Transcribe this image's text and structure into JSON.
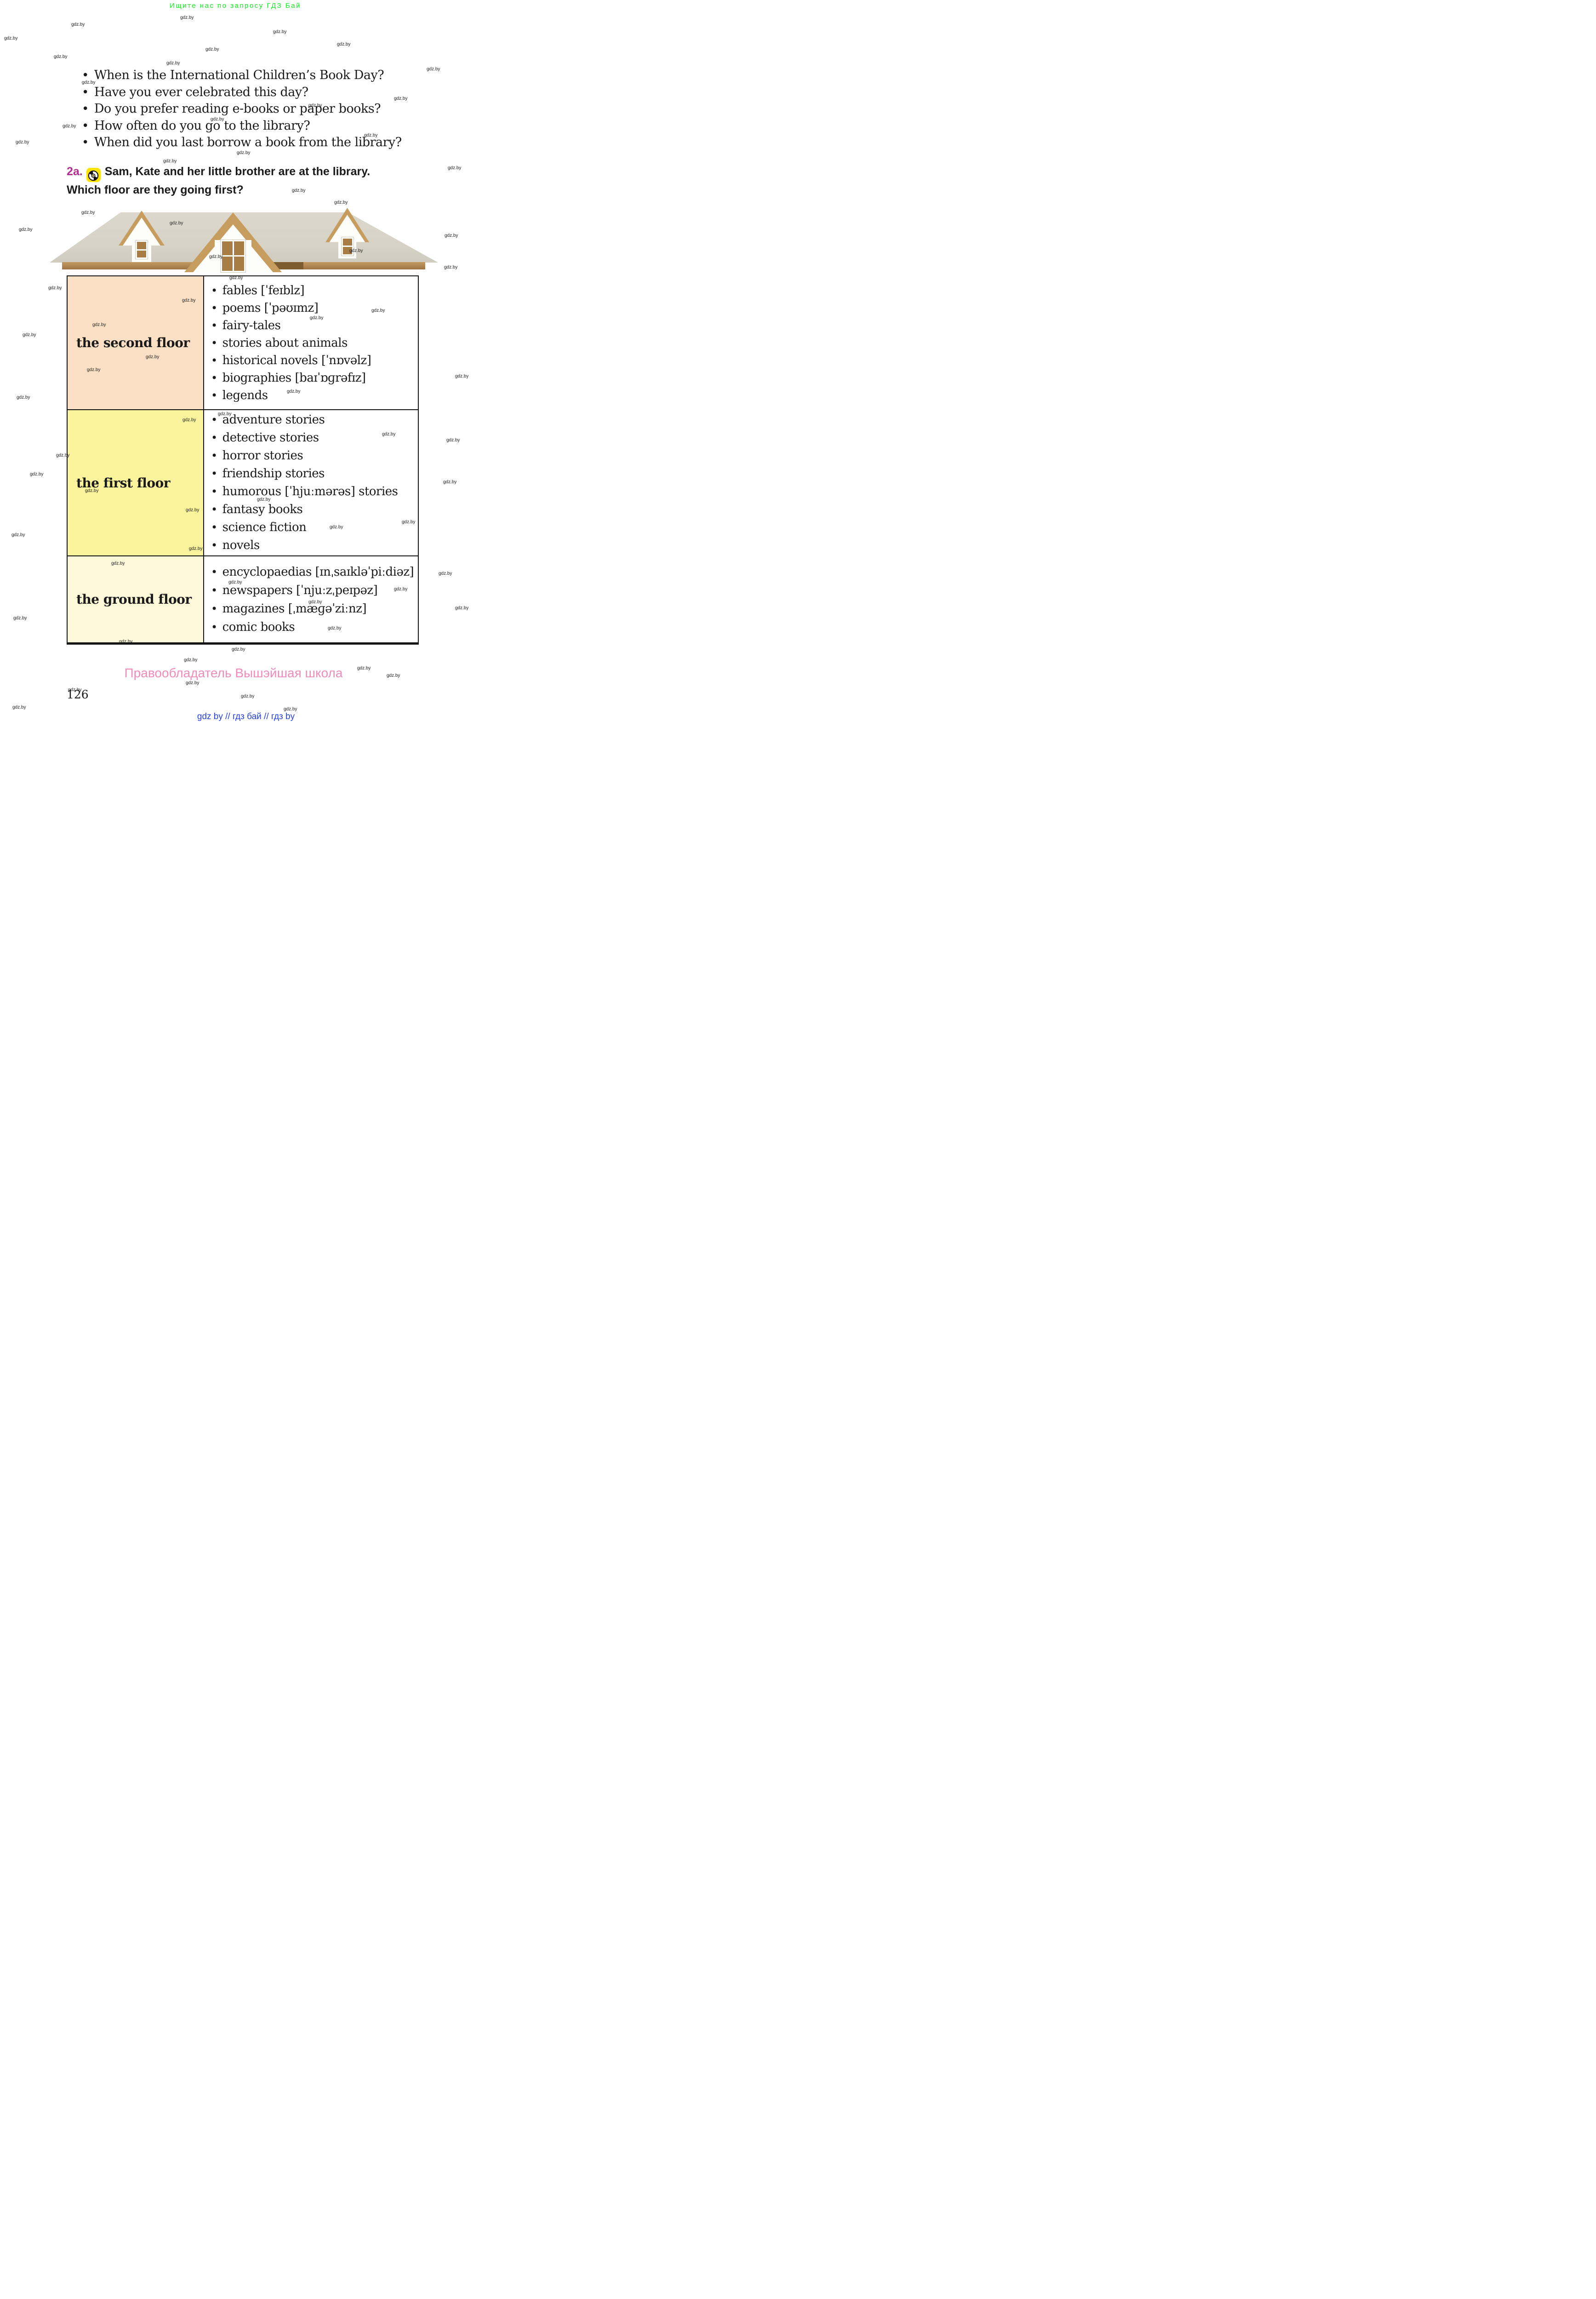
{
  "banner": {
    "text": "Ищите нас по запросу ГДЗ Бай",
    "color": "#0bf01b"
  },
  "watermark": {
    "text": "gdz.by",
    "positions": [
      [
        392,
        33
      ],
      [
        155,
        48
      ],
      [
        9,
        78
      ],
      [
        594,
        64
      ],
      [
        733,
        91
      ],
      [
        447,
        102
      ],
      [
        117,
        118
      ],
      [
        362,
        132
      ],
      [
        928,
        145
      ],
      [
        178,
        174
      ],
      [
        857,
        209
      ],
      [
        671,
        224
      ],
      [
        458,
        254
      ],
      [
        136,
        269
      ],
      [
        792,
        289
      ],
      [
        34,
        304
      ],
      [
        515,
        327
      ],
      [
        355,
        345
      ],
      [
        974,
        360
      ],
      [
        635,
        409
      ],
      [
        727,
        435
      ],
      [
        177,
        457
      ],
      [
        369,
        480
      ],
      [
        41,
        494
      ],
      [
        967,
        507
      ],
      [
        455,
        553
      ],
      [
        760,
        540
      ],
      [
        966,
        576
      ],
      [
        499,
        599
      ],
      [
        105,
        621
      ],
      [
        396,
        648
      ],
      [
        808,
        670
      ],
      [
        674,
        686
      ],
      [
        201,
        701
      ],
      [
        49,
        723
      ],
      [
        317,
        771
      ],
      [
        189,
        799
      ],
      [
        990,
        813
      ],
      [
        624,
        846
      ],
      [
        36,
        859
      ],
      [
        474,
        895
      ],
      [
        397,
        908
      ],
      [
        831,
        939
      ],
      [
        971,
        952
      ],
      [
        122,
        985
      ],
      [
        65,
        1026
      ],
      [
        964,
        1043
      ],
      [
        185,
        1062
      ],
      [
        559,
        1081
      ],
      [
        404,
        1104
      ],
      [
        874,
        1130
      ],
      [
        717,
        1141
      ],
      [
        25,
        1158
      ],
      [
        411,
        1188
      ],
      [
        242,
        1220
      ],
      [
        954,
        1242
      ],
      [
        497,
        1261
      ],
      [
        857,
        1276
      ],
      [
        671,
        1304
      ],
      [
        990,
        1317
      ],
      [
        29,
        1339
      ],
      [
        713,
        1361
      ],
      [
        259,
        1390
      ],
      [
        504,
        1407
      ],
      [
        400,
        1430
      ],
      [
        777,
        1448
      ],
      [
        841,
        1464
      ],
      [
        404,
        1480
      ],
      [
        148,
        1495
      ],
      [
        524,
        1509
      ],
      [
        27,
        1533
      ],
      [
        617,
        1537
      ]
    ]
  },
  "questions": {
    "items": [
      "When is the International Children’s Book Day?",
      "Have you ever celebrated this day?",
      "Do you prefer reading e-books or paper books?",
      "How often do you go to the library?",
      "When did you last borrow a book from the library?"
    ]
  },
  "exercise": {
    "number": "2a.",
    "icon": "cd-icon",
    "line1": "Sam, Kate and her little brother are at the library.",
    "line2": "Which floor are they going first?"
  },
  "library": {
    "floors": [
      {
        "label": "the second floor",
        "bg": "#fbe0c6",
        "items": [
          "fables [ˈfeɪblz]",
          "poems [ˈpəʊɪmz]",
          "fairy-tales",
          "stories about animals",
          "historical novels [ˈnɒvəlz]",
          "biographies [baɪˈɒɡrəfɪz]",
          "legends"
        ]
      },
      {
        "label": "the first floor",
        "bg": "#fbf49d",
        "items": [
          "adventure stories",
          "detective stories",
          "horror stories",
          "friendship stories",
          "humorous [ˈhjuːmərəs] stories",
          "fantasy books",
          "science fiction",
          "novels"
        ]
      },
      {
        "label": "the ground floor",
        "bg": "#fdf8da",
        "items": [
          "encyclopaedias [ɪnˌsaɪkləˈpiːdiəz]",
          "newspapers [ˈnjuːzˌpeɪpəz]",
          "magazines [ˌmæɡəˈziːnz]",
          "comic books"
        ]
      }
    ]
  },
  "footer": {
    "page_number": "126",
    "copyright": "Правообладатель Вышэйшая школа",
    "links": "gdz by  //  гдз бай  //  гдз by"
  },
  "colors": {
    "exercise_number": "#b02f90",
    "cd_badge": "#ffe400",
    "banner_green": "#0bf01b",
    "copyright_pink": "#f18cba",
    "links_blue": "#2640ee",
    "floor2_peach": "#fbe0c6",
    "floor1_yellow": "#fbf49d",
    "ground_cream": "#fdf8da",
    "roof_beige": "#d6d2c6",
    "fascia_brown": "#9d7442"
  }
}
